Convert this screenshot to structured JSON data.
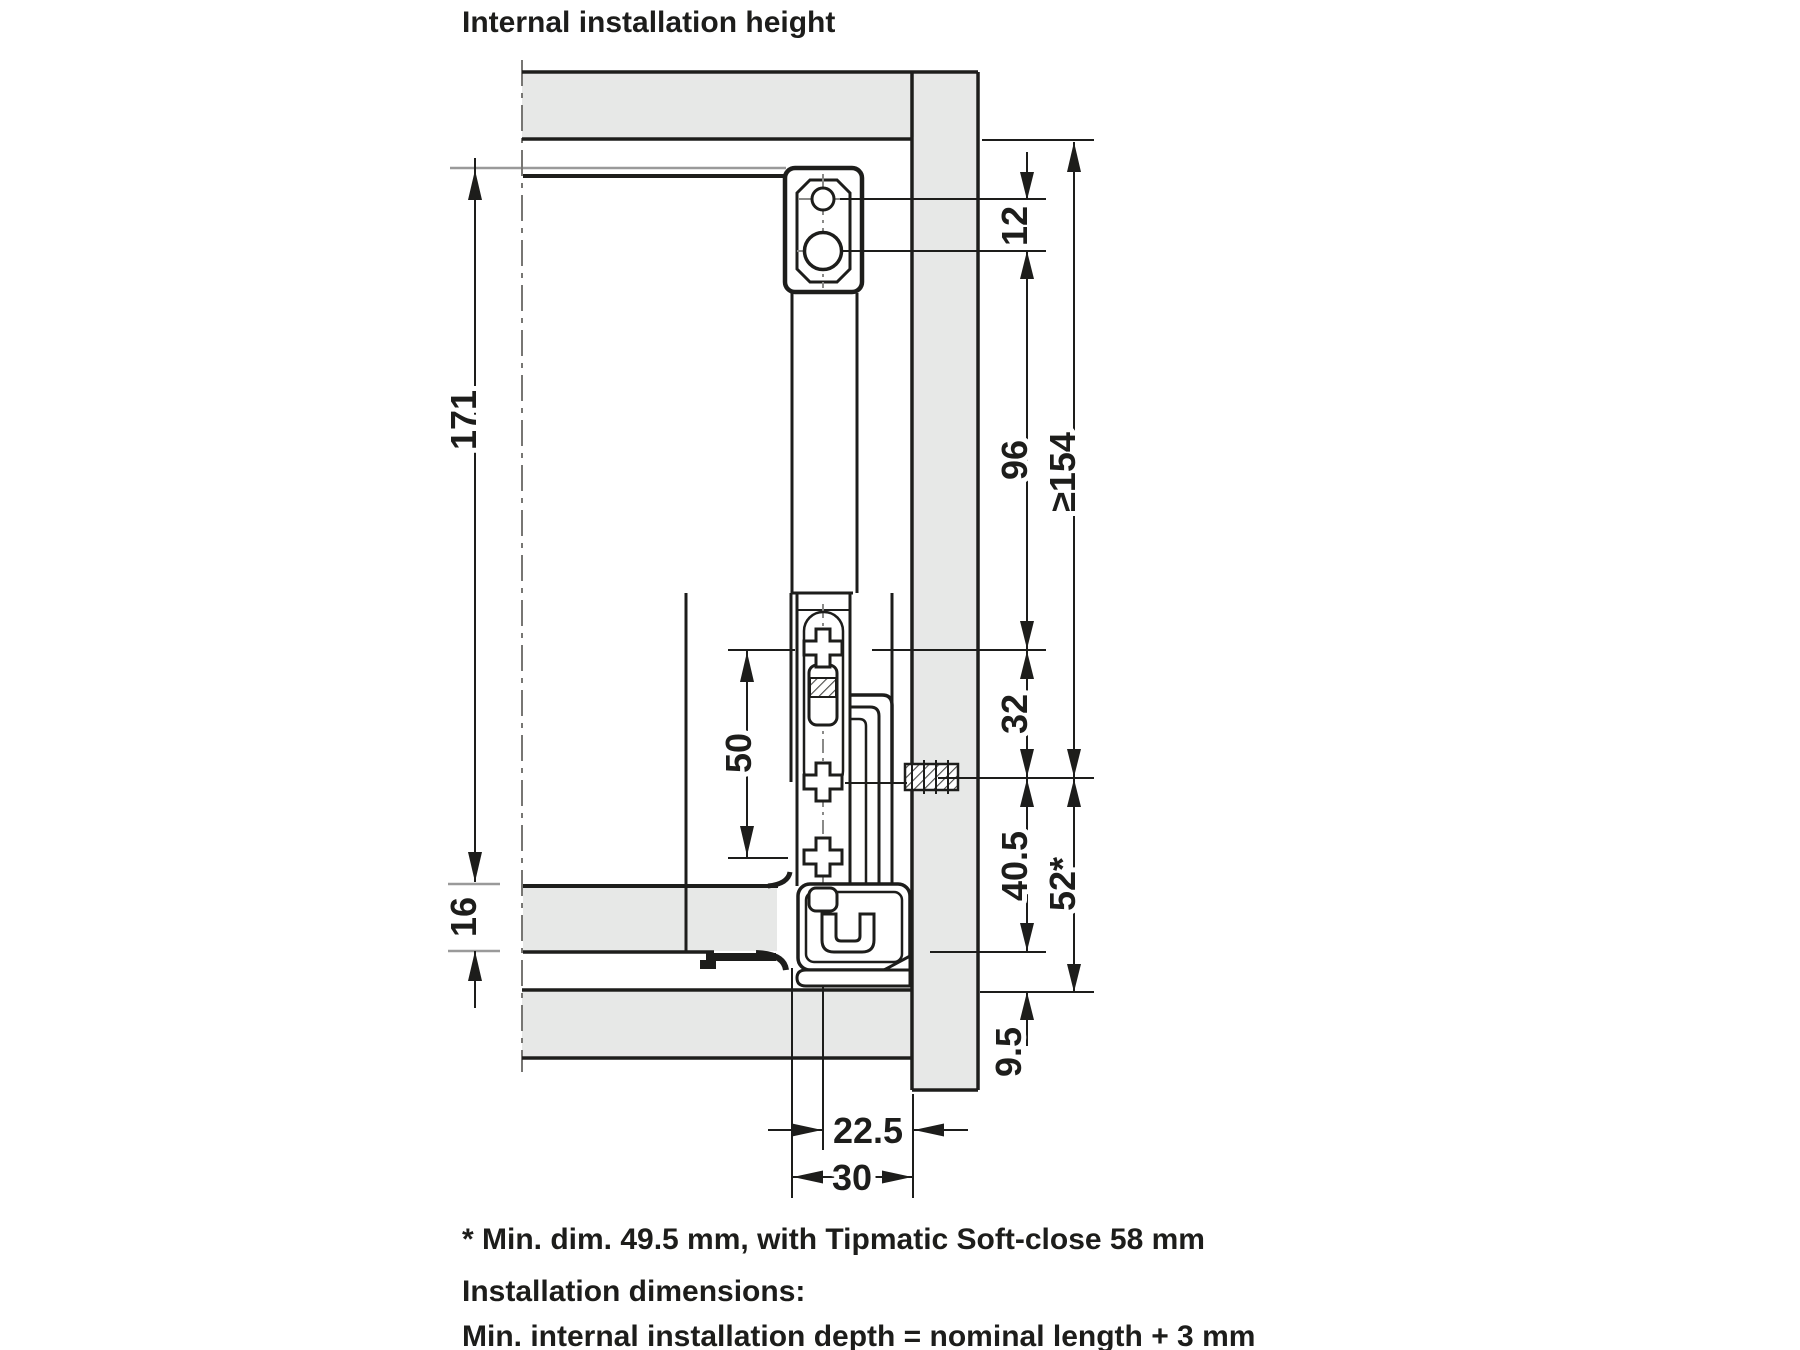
{
  "title": "Internal installation height",
  "dims": {
    "v171": "171",
    "v16": "16",
    "v50": "50",
    "v12": "12",
    "v96": "96",
    "v154": "≥154",
    "v32": "32",
    "v405": "40.5",
    "v52": "52*",
    "v95": "9.5",
    "v225": "22.5",
    "v30": "30"
  },
  "footnotes": {
    "line1": "* Min. dim. 49.5 mm, with Tipmatic Soft-close 58 mm",
    "line2": "Installation dimensions:",
    "line3": "Min. internal installation depth = nominal length + 3 mm"
  },
  "colors": {
    "line": "#1d1d1b",
    "panel_fill": "#e7e8e7",
    "extension_gray": "#9a9a9a"
  }
}
